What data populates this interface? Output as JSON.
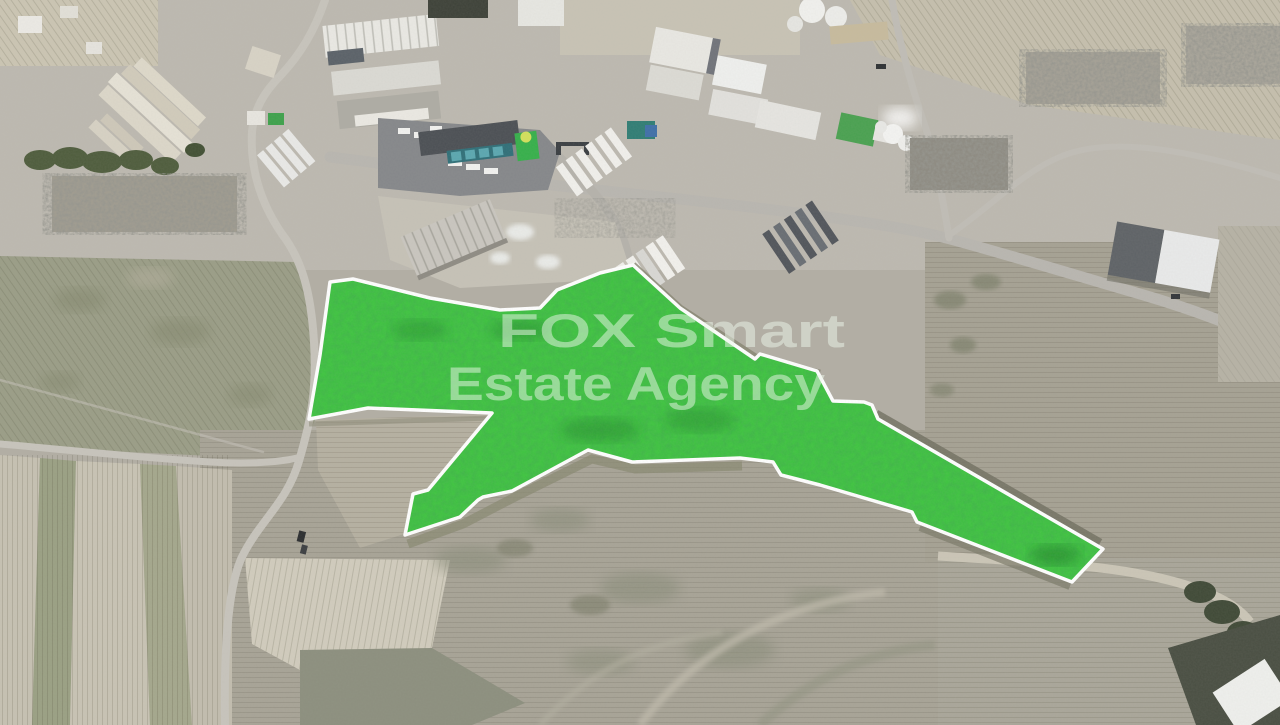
{
  "photo": {
    "watermark": {
      "line1": "FOX Smart",
      "line2": "Estate Agency",
      "opacity": "0.5"
    },
    "colors": {
      "parcel_fill": "#3ec440",
      "parcel_stroke": "#ffffff",
      "watermark_fill": "#edf7ea"
    },
    "parcel": {
      "points": "309,419 320,355 330,282 353,279 430,298 500,310 540,308 557,290 600,273 633,265 680,308 755,359 760,354 817,371 833,401 864,402 872,405 878,419 1103,549 1072,582 917,522 912,512 820,485 781,475 773,462 740,458 632,462 588,450 512,491 483,497 478,500 460,517 405,535 413,494 428,490 492,413 368,408"
    }
  }
}
